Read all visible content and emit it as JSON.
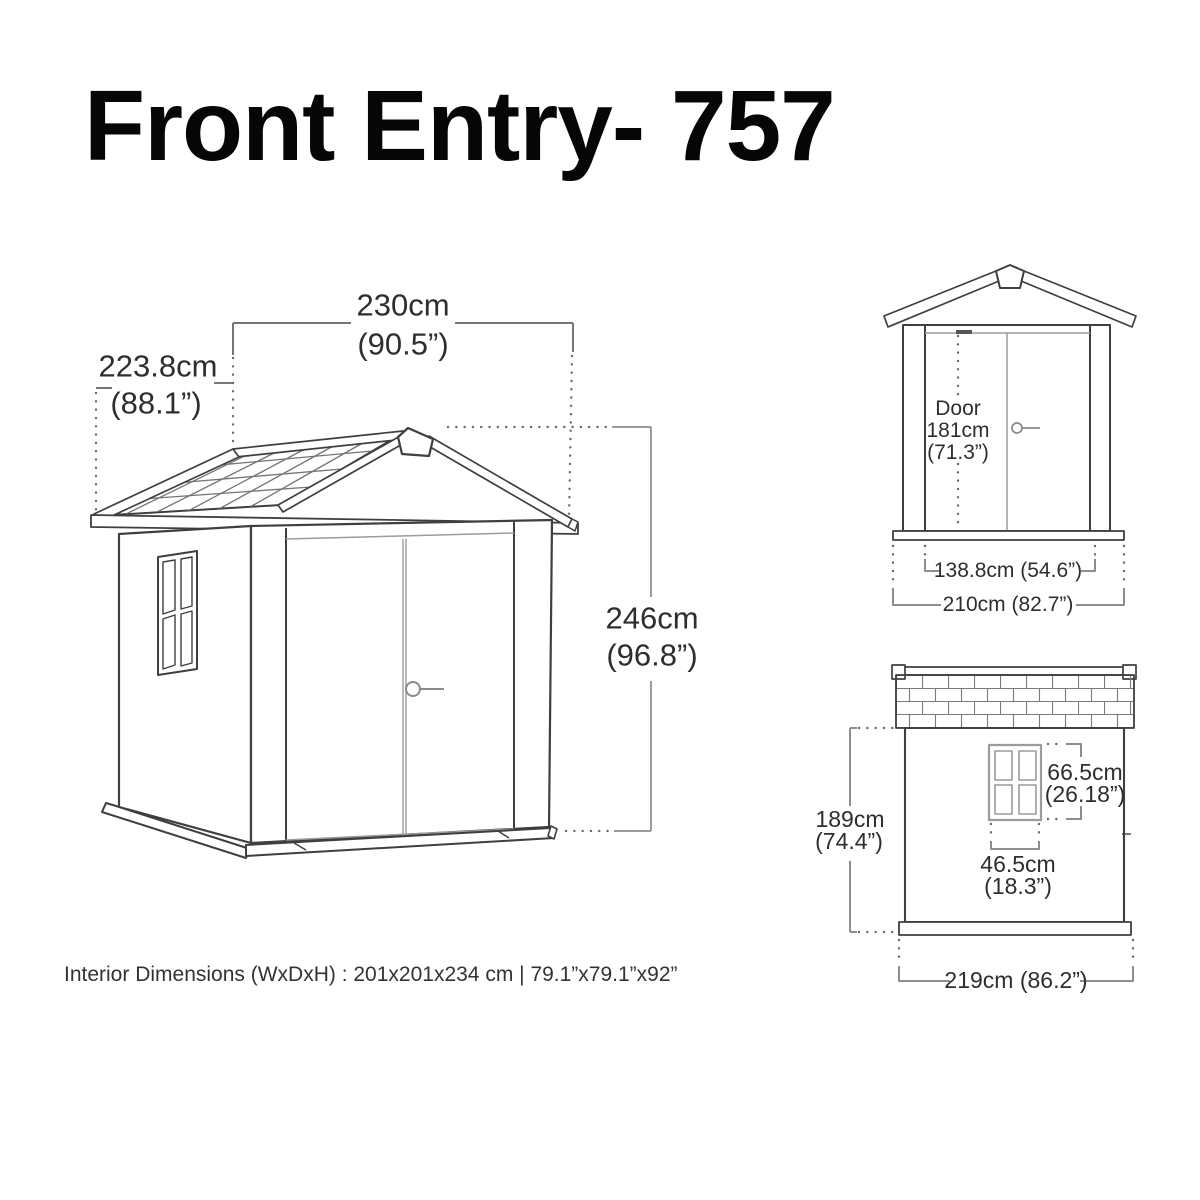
{
  "title": "Front Entry- 757",
  "colors": {
    "background": "#ffffff",
    "outline_ink": "#3f3f3f",
    "dimension_line": "#8d8d8d",
    "text": "#2e2e2e"
  },
  "main_view": {
    "width_cm": "230cm",
    "width_in": "(90.5”)",
    "depth_cm": "223.8cm",
    "depth_in": "(88.1”)",
    "height_cm": "246cm",
    "height_in": "(96.8”)"
  },
  "front_view": {
    "door_word": "Door",
    "door_height_cm": "181cm",
    "door_height_in": "(71.3”)",
    "door_width": "138.8cm (54.6”)",
    "overall_width": "210cm (82.7”)"
  },
  "side_view": {
    "wall_height_cm": "189cm",
    "wall_height_in": "(74.4”)",
    "window_height_cm": "66.5cm",
    "window_height_in": "(26.18”)",
    "window_width_cm": "46.5cm",
    "window_width_in": "(18.3”)",
    "overall_depth": "219cm (86.2”)"
  },
  "footer": {
    "interior_dimensions": "Interior Dimensions (WxDxH) : 201x201x234 cm | 79.1”x79.1”x92”"
  }
}
